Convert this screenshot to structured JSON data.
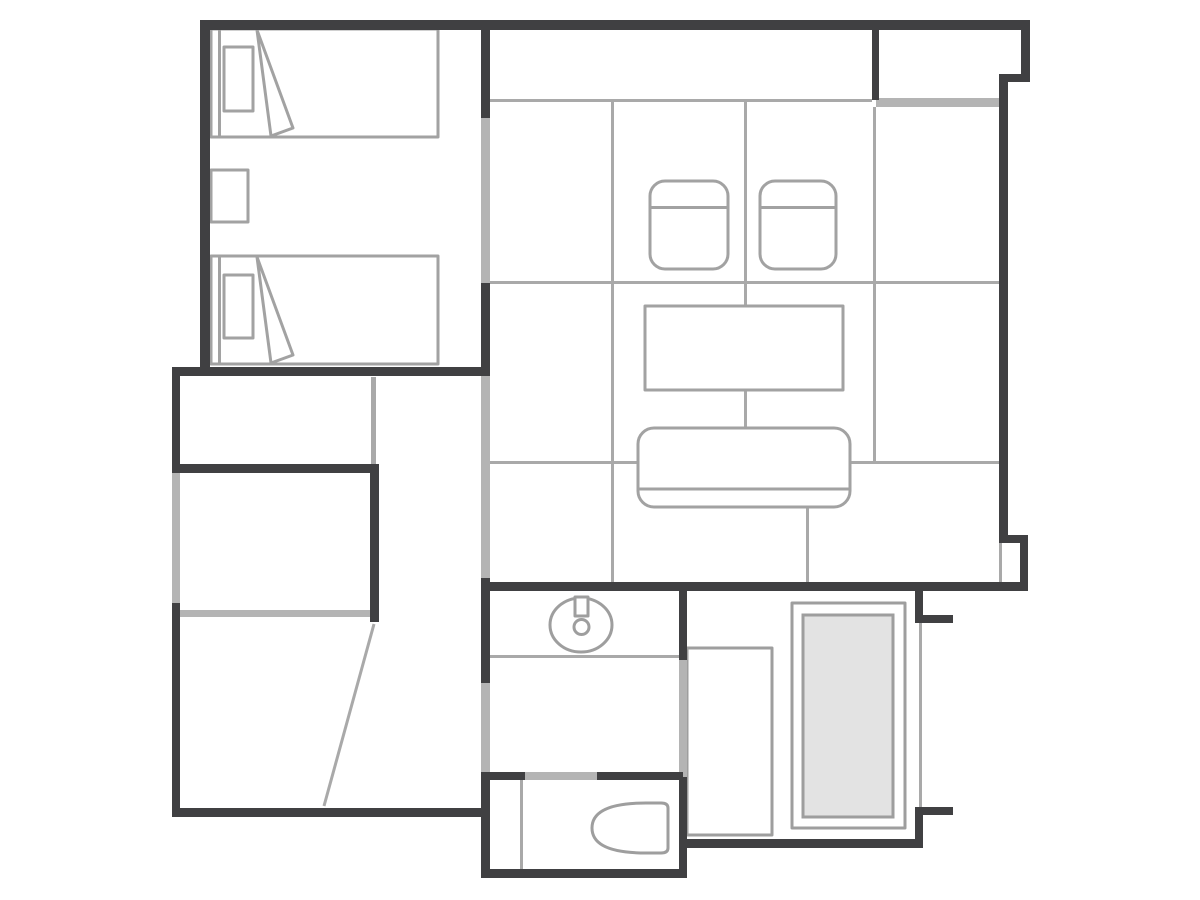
{
  "document": {
    "title": "Floor Plan"
  },
  "colors": {
    "background": "#ffffff",
    "wall": "#404042",
    "slidingDoor": "#b4b4b4",
    "line": "#a9a9a9",
    "furniture": "#a2a2a2",
    "fixture": "#9e9e9e",
    "bathtubFill": "#e3e3e3"
  },
  "plan": {
    "type": "hotel-guest-room-floor-plan",
    "rooms": [
      {
        "name": "twin-bedroom",
        "furniture": [
          "bed",
          "bed",
          "nightstand"
        ]
      },
      {
        "name": "tatami-room",
        "furniture": [
          "chair",
          "chair",
          "table",
          "sofa"
        ]
      },
      {
        "name": "veranda-strip",
        "furniture": []
      },
      {
        "name": "alcove-closet",
        "furniture": []
      },
      {
        "name": "closet-upper",
        "furniture": []
      },
      {
        "name": "closet-lower",
        "furniture": []
      },
      {
        "name": "entrance-hall",
        "furniture": [
          "door-swing-line"
        ]
      },
      {
        "name": "washroom",
        "furniture": [
          "washbasin"
        ]
      },
      {
        "name": "toilet-room",
        "furniture": [
          "toilet"
        ]
      },
      {
        "name": "bathroom",
        "furniture": [
          "bathtub",
          "shower-tray"
        ]
      }
    ]
  }
}
